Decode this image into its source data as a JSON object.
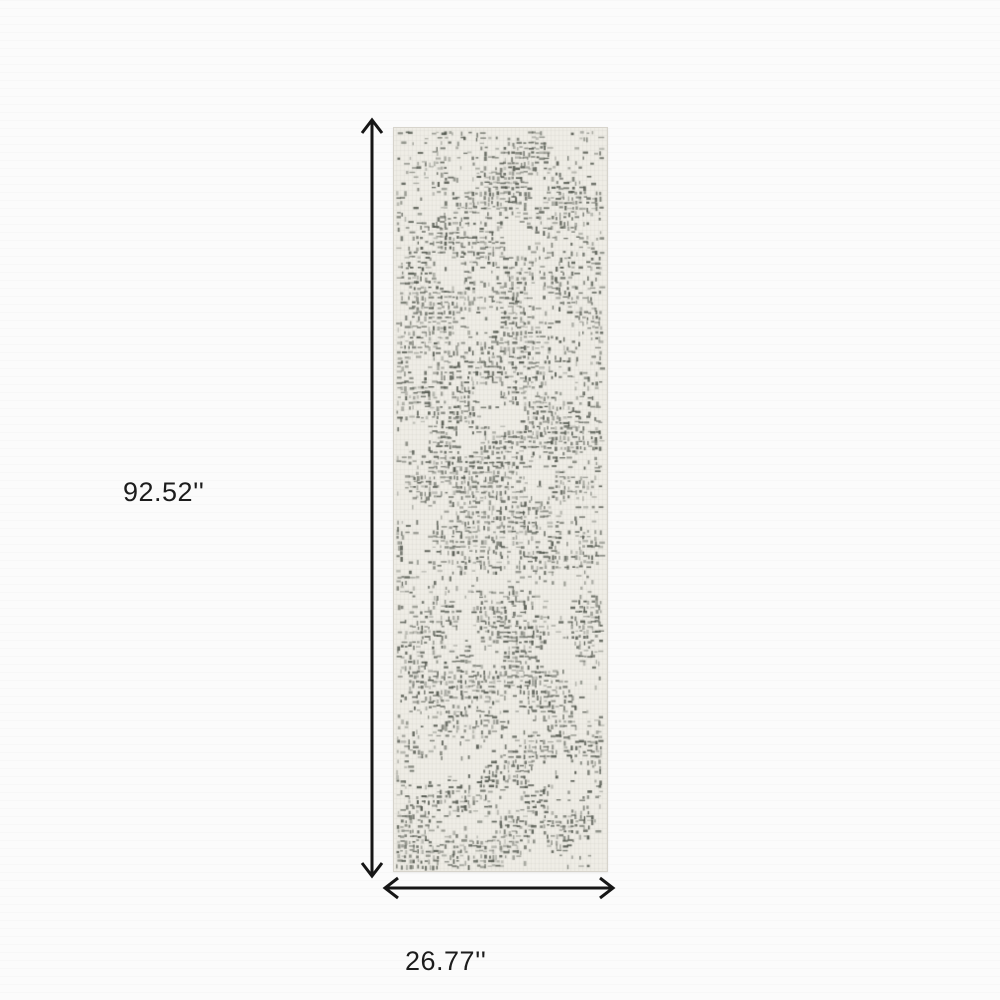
{
  "diagram": {
    "kind": "product-dimension-diagram",
    "height_label": "92.52''",
    "width_label": "26.77''"
  },
  "rug": {
    "description": "grey and ivory distressed crosshatch runner rug",
    "base_color": "#EFEDE6",
    "pattern_color": "#50554C",
    "edge_color": "#D7D4CC"
  },
  "colors": {
    "background": "#FBFBFB",
    "arrow": "#161616",
    "text": "#1C1C1C"
  }
}
